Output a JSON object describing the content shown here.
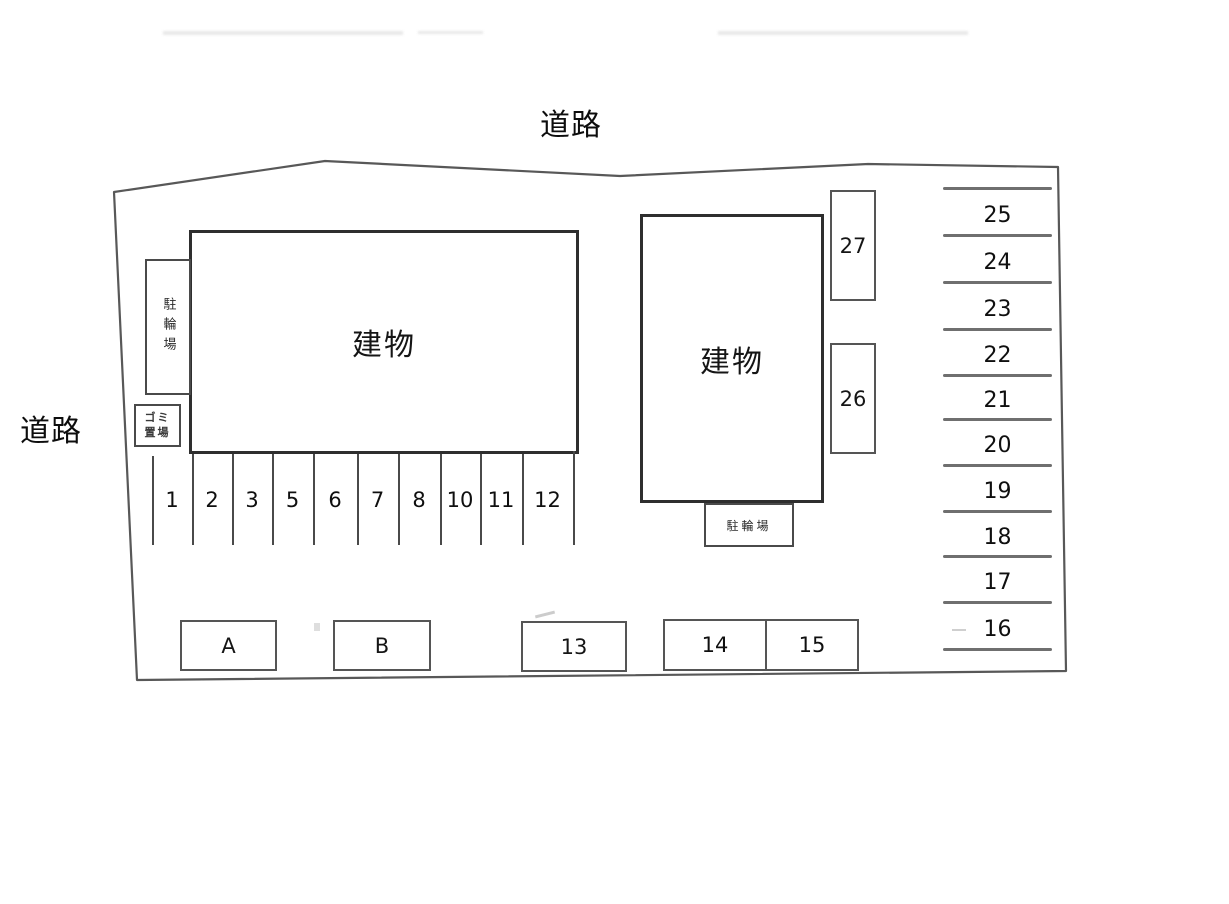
{
  "diagram": {
    "type": "parking-site-plan",
    "roads": {
      "top": "道路",
      "left": "道路"
    },
    "buildings": [
      {
        "label": "建物"
      },
      {
        "label": "建物"
      }
    ],
    "bicycle_parking": [
      {
        "label": "駐輪場"
      },
      {
        "label": "駐輪場"
      }
    ],
    "garbage_area": {
      "line1": "ゴミ",
      "line2": "置場"
    },
    "parking_spaces": {
      "top_row": [
        "1",
        "2",
        "3",
        "5",
        "6",
        "7",
        "8",
        "10",
        "11",
        "12"
      ],
      "middle_column": [
        "27",
        "26"
      ],
      "right_column": [
        "25",
        "24",
        "23",
        "22",
        "21",
        "20",
        "19",
        "18",
        "17",
        "16"
      ],
      "bottom_row": [
        "A",
        "B",
        "13",
        "14",
        "15"
      ]
    },
    "colors": {
      "background": "#ffffff",
      "boundary_line": "#585858",
      "building_line": "#2e2e2e",
      "divider_line": "#4a4a4a",
      "text": "#151515"
    }
  }
}
